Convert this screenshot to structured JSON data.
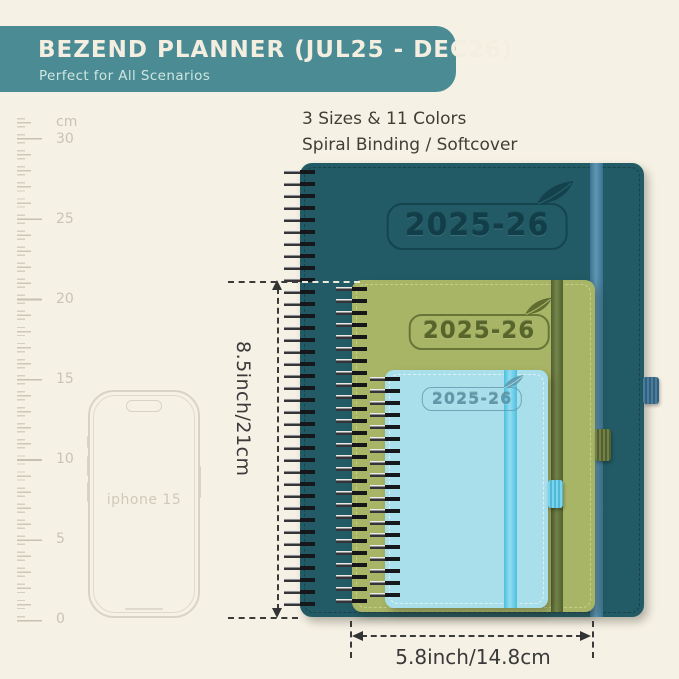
{
  "header": {
    "title": "BEZEND PLANNER (JUL25 - DEC26)",
    "subtitle": "Perfect for All Scenarios",
    "bg_color": "#4a8b94"
  },
  "info": {
    "line1": "3 Sizes & 11 Colors",
    "line2": "Spiral Binding / Softcover"
  },
  "ruler": {
    "unit_label": "cm",
    "labels": [
      "30",
      "25",
      "20",
      "15",
      "10",
      "5",
      "0"
    ]
  },
  "phone": {
    "label": "iphone 15"
  },
  "planners": {
    "large": {
      "label": "2025-26",
      "color": "#225b65",
      "band_color": "#4a82a0"
    },
    "medium": {
      "label": "2025-26",
      "color": "#a9b566",
      "band_color": "#5c6b35"
    },
    "small": {
      "label": "2025-26",
      "color": "#a9dfea",
      "band_color": "#58c6e4"
    }
  },
  "dimensions": {
    "height_label": "8.5inch/21cm",
    "width_label": "5.8inch/14.8cm"
  },
  "colors": {
    "background": "#f6f1e5",
    "annotation": "#3a3a3a",
    "ruler": "#c9c3b2"
  }
}
